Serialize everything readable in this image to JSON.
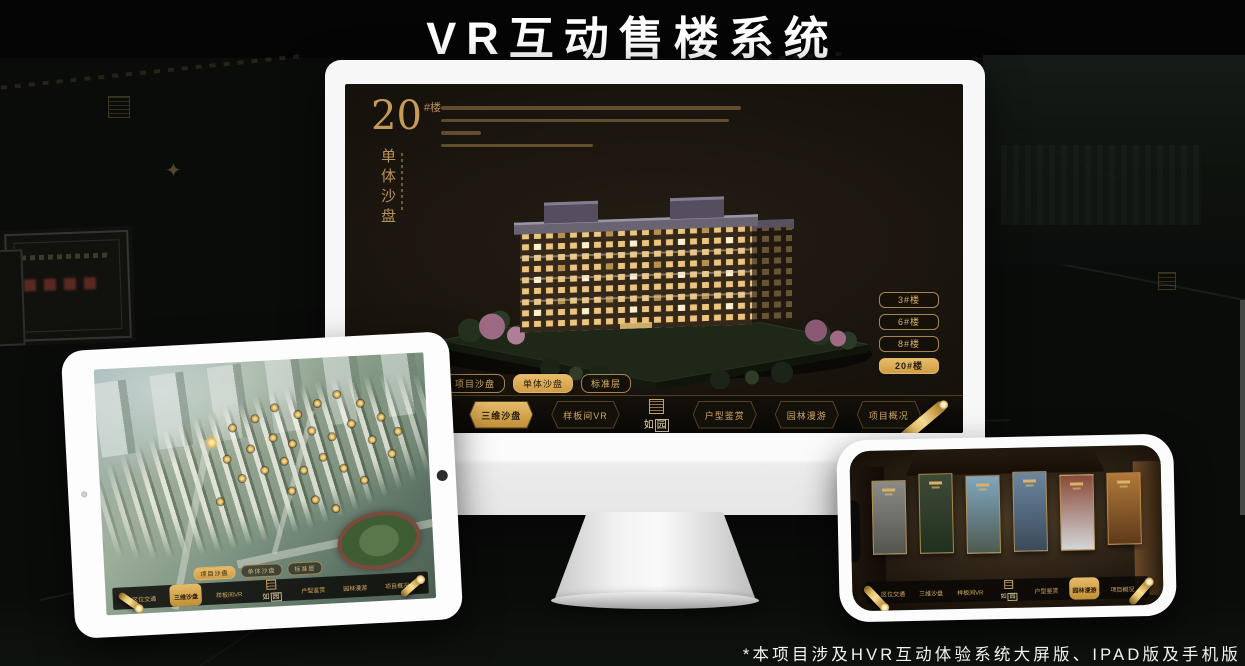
{
  "page": {
    "title": "VR互动售楼系统",
    "footnote": "*本项目涉及HVR互动体验系统大屏版、IPAD版及手机版"
  },
  "brand": {
    "logo_char_1": "如",
    "logo_char_2": "园"
  },
  "nav": {
    "items": [
      {
        "label": "区位交通"
      },
      {
        "label": "三维沙盘"
      },
      {
        "label": "样板间VR"
      },
      {
        "label": "户型鉴赏"
      },
      {
        "label": "园林漫游"
      },
      {
        "label": "项目概况"
      }
    ]
  },
  "monitor": {
    "active_nav_index": 1,
    "header": {
      "number": "20",
      "suffix": "#楼",
      "vertical_label": "单体沙盘"
    },
    "floor_buttons": [
      {
        "label": "3#楼",
        "active": false
      },
      {
        "label": "6#楼",
        "active": false
      },
      {
        "label": "8#楼",
        "active": false
      },
      {
        "label": "20#楼",
        "active": true
      }
    ],
    "subtabs": [
      {
        "label": "项目沙盘",
        "active": false
      },
      {
        "label": "单体沙盘",
        "active": true
      },
      {
        "label": "标准层",
        "active": false
      }
    ]
  },
  "tablet": {
    "active_nav_index": 1,
    "subtabs": [
      {
        "label": "项目沙盘",
        "active": true
      },
      {
        "label": "单体沙盘",
        "active": false
      },
      {
        "label": "标准层",
        "active": false
      }
    ],
    "badges": [
      [
        33,
        30
      ],
      [
        40,
        25
      ],
      [
        47,
        22
      ],
      [
        53,
        18
      ],
      [
        60,
        21
      ],
      [
        66,
        17
      ],
      [
        72,
        14
      ],
      [
        79,
        18
      ],
      [
        85,
        24
      ],
      [
        90,
        30
      ],
      [
        38,
        38
      ],
      [
        45,
        34
      ],
      [
        52,
        30
      ],
      [
        58,
        33
      ],
      [
        64,
        28
      ],
      [
        70,
        31
      ],
      [
        76,
        26
      ],
      [
        82,
        33
      ],
      [
        88,
        39
      ],
      [
        42,
        46
      ],
      [
        49,
        43
      ],
      [
        55,
        40
      ],
      [
        61,
        44
      ],
      [
        67,
        39
      ],
      [
        73,
        44
      ],
      [
        79,
        49
      ],
      [
        57,
        52
      ],
      [
        64,
        56
      ],
      [
        70,
        60
      ],
      [
        35,
        55
      ]
    ],
    "active_badge_index": 0
  },
  "phone": {
    "active_nav_index": 4,
    "panels": [
      {
        "top": "#8a8a86",
        "bottom": "#55554f",
        "height": 72,
        "offset": 6
      },
      {
        "top": "#3e4a36",
        "bottom": "#20301e",
        "height": 78,
        "offset": 0
      },
      {
        "top": "#7fa7c0",
        "bottom": "#4e5a50",
        "height": 76,
        "offset": 3
      },
      {
        "top": "#6b86a0",
        "bottom": "#3a4a5a",
        "height": 78,
        "offset": 0
      },
      {
        "top": "#8a4a38",
        "bottom": "#d4d6d8",
        "height": 74,
        "offset": 4
      },
      {
        "top": "#b07838",
        "bottom": "#5e3a1c",
        "height": 70,
        "offset": 3
      }
    ]
  },
  "colors": {
    "gold": "#c9a25e",
    "gold_bright": "#e2b564",
    "gold_fill": "#d9a94f",
    "screen_bg": "#16120d",
    "nav_bg": "#0c0a07",
    "window_amber": "#edc57e",
    "roof_gray": "#6a6472"
  }
}
